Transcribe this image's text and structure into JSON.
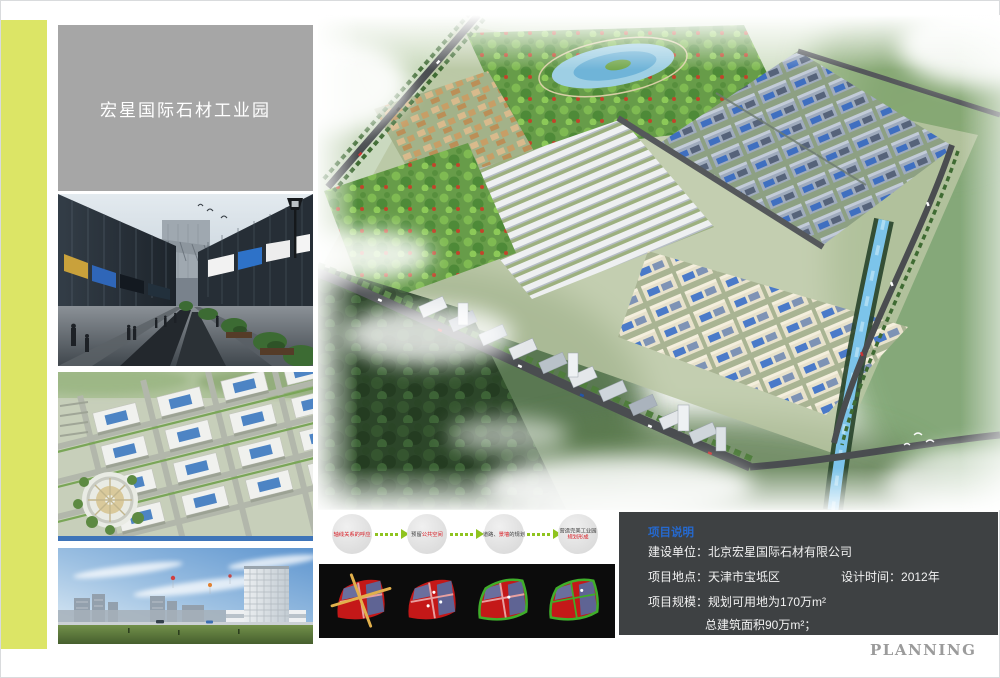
{
  "page": {
    "background": "#ffffff",
    "accent_stripe_color": "#dce566",
    "footer_text": "PLANNING"
  },
  "header": {
    "title": "宏星国际石材工业园",
    "box_color": "#a6a6a6"
  },
  "sidebar_photos": [
    {
      "name": "commercial-street-rendering"
    },
    {
      "name": "industrial-park-aerial-rendering"
    },
    {
      "name": "office-building-skyline-rendering"
    }
  ],
  "main_rendering": {
    "name": "masterplan-aerial-rendering"
  },
  "process_flow": {
    "arrow_color": "#8fc31f",
    "steps": [
      {
        "pre": "",
        "accent": "轴线关系的呼应",
        "post": ""
      },
      {
        "pre": "预留",
        "accent": "公共空间",
        "post": ""
      },
      {
        "pre": "道路、",
        "accent": "景墙",
        "post": "的规划"
      },
      {
        "pre": "营造完美工业园",
        "accent": "规划形成",
        "post": ""
      }
    ]
  },
  "concept_diagrams": {
    "panel_color": "#0c0c0c",
    "items": [
      {
        "name": "site-axes-diagram"
      },
      {
        "name": "land-parcel-diagram"
      },
      {
        "name": "ring-road-diagram"
      },
      {
        "name": "road-network-diagram"
      }
    ]
  },
  "project_info": {
    "panel_color": "#3e4143",
    "heading": "项目说明",
    "heading_color": "#2569cf",
    "rows": {
      "owner_label": "建设单位：",
      "owner_value": "北京宏星国际石材有限公司",
      "location_label": "项目地点：",
      "location_value": "天津市宝坻区",
      "design_time_label": "设计时间：",
      "design_time_value": "2012年",
      "scale_label": "项目规模：",
      "scale_value": "规划可用地为170万m²",
      "scale_value2": "总建筑面积90万m²；"
    }
  }
}
